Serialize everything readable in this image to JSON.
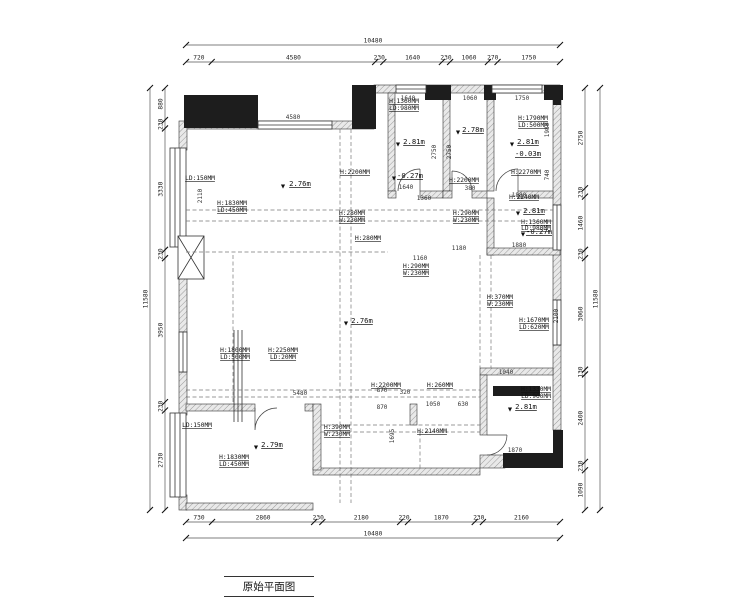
{
  "title": "原始平面图",
  "symbols": {
    "level": "▼"
  },
  "dims": {
    "top_total": "10480",
    "top_segments": [
      "720",
      "4580",
      "230",
      "1640",
      "230",
      "1060",
      "270",
      "1750"
    ],
    "bottom_total": "10480",
    "bottom_segments": [
      "730",
      "2860",
      "230",
      "2180",
      "220",
      "1870",
      "230",
      "2160"
    ],
    "left_total": "11580",
    "left_segments": [
      "880",
      "230",
      "3330",
      "230",
      "3950",
      "230",
      "2730"
    ],
    "right_total": "11580",
    "right_segments": [
      "2750",
      "230",
      "1460",
      "230",
      "3060",
      "130",
      "2400",
      "230",
      "1090"
    ]
  },
  "rooms": {
    "top_left": {
      "height": "2.76m"
    },
    "top_mid1": {
      "height": "2.81m",
      "level": "-0.27m"
    },
    "top_mid2": {
      "height": "2.78m"
    },
    "top_right": {
      "height": "2.81m",
      "level": "-0.03m"
    },
    "right_mid": {
      "height": "2.81m",
      "level": "-0.27m"
    },
    "center": {
      "height": "2.76m"
    },
    "bottom_left": {
      "height": "2.79m"
    },
    "bottom_right": {
      "height": "2.81m"
    }
  },
  "ann": {
    "b_win_h": "H:1360MM",
    "b_win_ld": "LD:980MM",
    "d_win_h": "H:1790MM",
    "d_win_ld": "LD:500MM",
    "a_door_h": "H:2200MM",
    "c_door_h": "H:2200MM",
    "d_door_h": "H:2270MM",
    "a_win_h": "H:1830MM",
    "a_win_ld": "LD:450MM",
    "a_bay_ld": "LD:150MM",
    "e_door_h": "H:2240MM",
    "e_win_h": "H:1360MM",
    "e_win_ld": "LD:980MM",
    "beam_a_h": "H:280MM",
    "beam_a_w": "W:230MM",
    "beam_b_h": "H:290MM",
    "beam_b_w": "W:230MM",
    "beam_c_h": "H:280MM",
    "beam_d_h": "H:290MM",
    "beam_d_w": "W:230MM",
    "beam_e_h": "H:370MM",
    "beam_e_w": "W:230MM",
    "f_rwin_h": "H:1670MM",
    "f_rwin_ld": "LD:620MM",
    "f_lwin_h": "H:1800MM",
    "f_lwin_ld": "LD:500MM",
    "f_bwin_h": "H:2250MM",
    "f_bwin_ld": "LD:20MM",
    "h_door_h": "H:2200MM",
    "beam_f_h": "H:260MM",
    "beam_g_h": "H:390MM",
    "beam_g_w": "W:230MM",
    "h_pass_h": "H:2140MM",
    "i_win_h": "H:1330MM",
    "i_win_ld": "LD:960MM",
    "g_win_h": "H:1830MM",
    "g_win_ld": "LD:450MM",
    "g_bay_ld": "LD:150MM"
  },
  "int_dims": {
    "a_top": "4580",
    "b_top": "1640",
    "c_top": "1060",
    "d_top": "1750",
    "b_bot": "1640",
    "b_side": "380",
    "e_top": "1880",
    "e_bot": "1880",
    "mid_a": "1360",
    "mid_b": "1180",
    "mid_c": "1160",
    "pass_a": "870",
    "pass_b": "870",
    "pass_c": "320",
    "pass_d": "1050",
    "pass_e": "630",
    "f_bot": "5480",
    "i_top": "1040",
    "i_bot": "1870",
    "v_b1": "2750",
    "v_b2": "2750",
    "v_d1": "1980",
    "v_d2": "740",
    "v_i": "2100",
    "v_h": "1695",
    "v_a": "2110"
  }
}
